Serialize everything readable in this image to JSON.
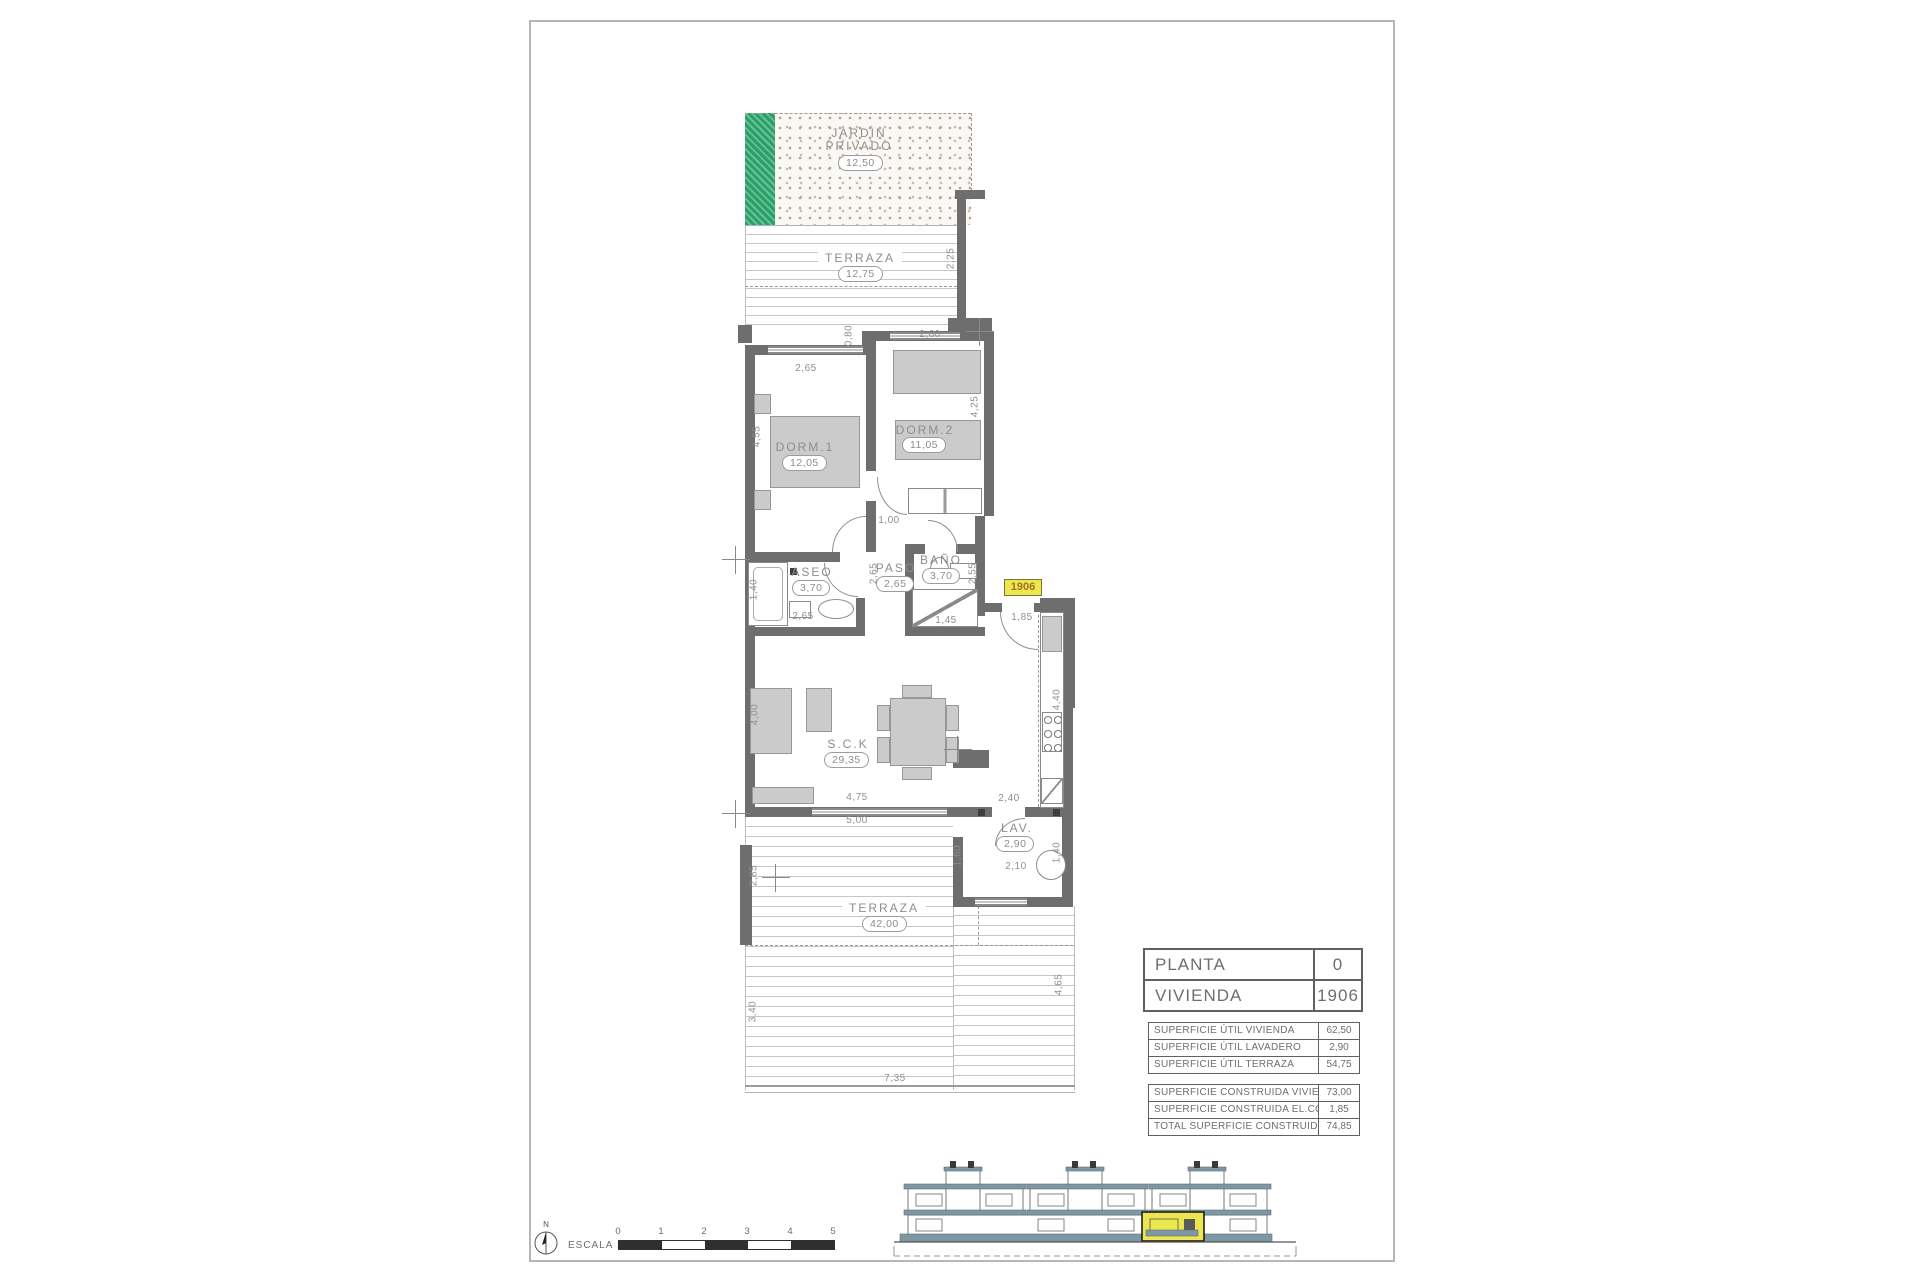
{
  "rooms": {
    "jardin": {
      "label": "JARDIN",
      "label2": "PRIVADO",
      "area": "12,50"
    },
    "terraza_top": {
      "label": "TERRAZA",
      "area": "12,75"
    },
    "dorm1": {
      "label": "DORM.1",
      "area": "12,05"
    },
    "dorm2": {
      "label": "DORM.2",
      "area": "11,05"
    },
    "aseo": {
      "label": "ASEO",
      "area": "3,70"
    },
    "paso": {
      "label": "PASO",
      "area": "2,65"
    },
    "bano": {
      "label": "BAÑO",
      "area": "3,70"
    },
    "sck": {
      "label": "S.C.K",
      "area": "29,35"
    },
    "lav": {
      "label": "LAV.",
      "area": "2,90"
    },
    "terraza_bottom": {
      "label": "TERRAZA",
      "area": "42,00"
    }
  },
  "unit_tag": "1906",
  "dims": {
    "d225": "2,25",
    "d080": "0,80",
    "d260": "2,60",
    "d265a": "2,65",
    "d455": "4,55",
    "d425": "4,25",
    "d100": "1,00",
    "d140a": "1,40",
    "d265b": "2,65",
    "d265c": "2,65",
    "d255": "2,55",
    "d145": "1,45",
    "d185": "1,85",
    "d400": "4,00",
    "d475": "4,75",
    "d500": "5,00",
    "d440": "4,40",
    "d240": "2,40",
    "d160": "1,60",
    "d140b": "1,40",
    "d210": "2,10",
    "d285": "2,85",
    "d340": "3,40",
    "d465": "4,65",
    "d735": "7,35"
  },
  "tables": {
    "info": {
      "rows": [
        {
          "label": "PLANTA",
          "value": "0"
        },
        {
          "label": "VIVIENDA",
          "value": "1906"
        }
      ]
    },
    "util": {
      "rows": [
        {
          "label": "SUPERFICIE ÚTIL VIVIENDA",
          "value": "62,50"
        },
        {
          "label": "SUPERFICIE ÚTIL LAVADERO",
          "value": "2,90"
        },
        {
          "label": "SUPERFICIE ÚTIL TERRAZA",
          "value": "54,75"
        }
      ]
    },
    "built": {
      "rows": [
        {
          "label": "SUPERFICIE CONSTRUIDA VIVIENDA",
          "value": "73,00"
        },
        {
          "label": "SUPERFICIE CONSTRUIDA EL.COMUNES",
          "value": "1,85"
        },
        {
          "label": "TOTAL SUPERFICIE CONSTRUIDA",
          "value": "74,85"
        }
      ]
    }
  },
  "scale": {
    "label": "ESCALA :",
    "ticks": [
      "0",
      "1",
      "2",
      "3",
      "4",
      "5"
    ]
  },
  "compass": {
    "label": "N"
  },
  "colors": {
    "wall": "#6e6e6e",
    "garden_green": "#2e9e68",
    "highlight_yellow": "#ece74f",
    "elevation_teal": "#7e97a2"
  }
}
